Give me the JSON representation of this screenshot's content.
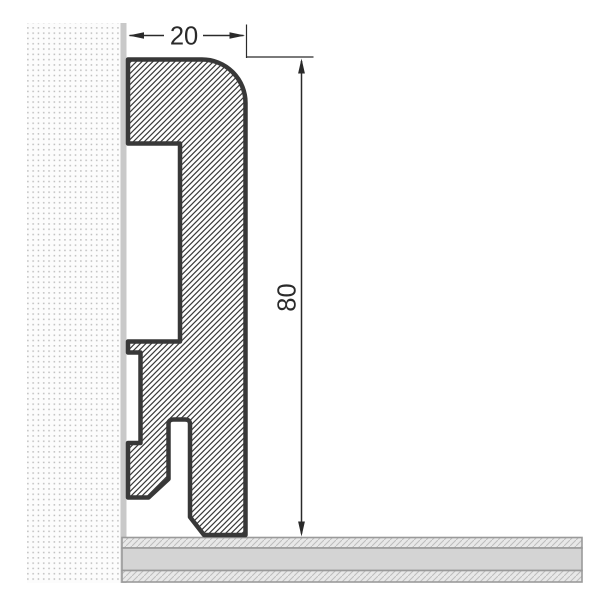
{
  "title": "Skirting board profile cross-section drawing",
  "dimensions": {
    "width": {
      "label": "20"
    },
    "height": {
      "label": "80"
    }
  },
  "colors": {
    "background": "#ffffff",
    "outline": "#383838",
    "hatch_line": "#3a3a3a",
    "dimension": "#2a2a2a",
    "wall_dot": "#bdbdbd",
    "wall_background": "#fcfcfc",
    "wall_strip": "#c9c9c9",
    "floor_solid": "#d4d4d4",
    "floor_border": "#9a9a9a",
    "floor_hatch_background": "#e8e8e8",
    "floor_hatch_line": "#bdbdbd"
  }
}
